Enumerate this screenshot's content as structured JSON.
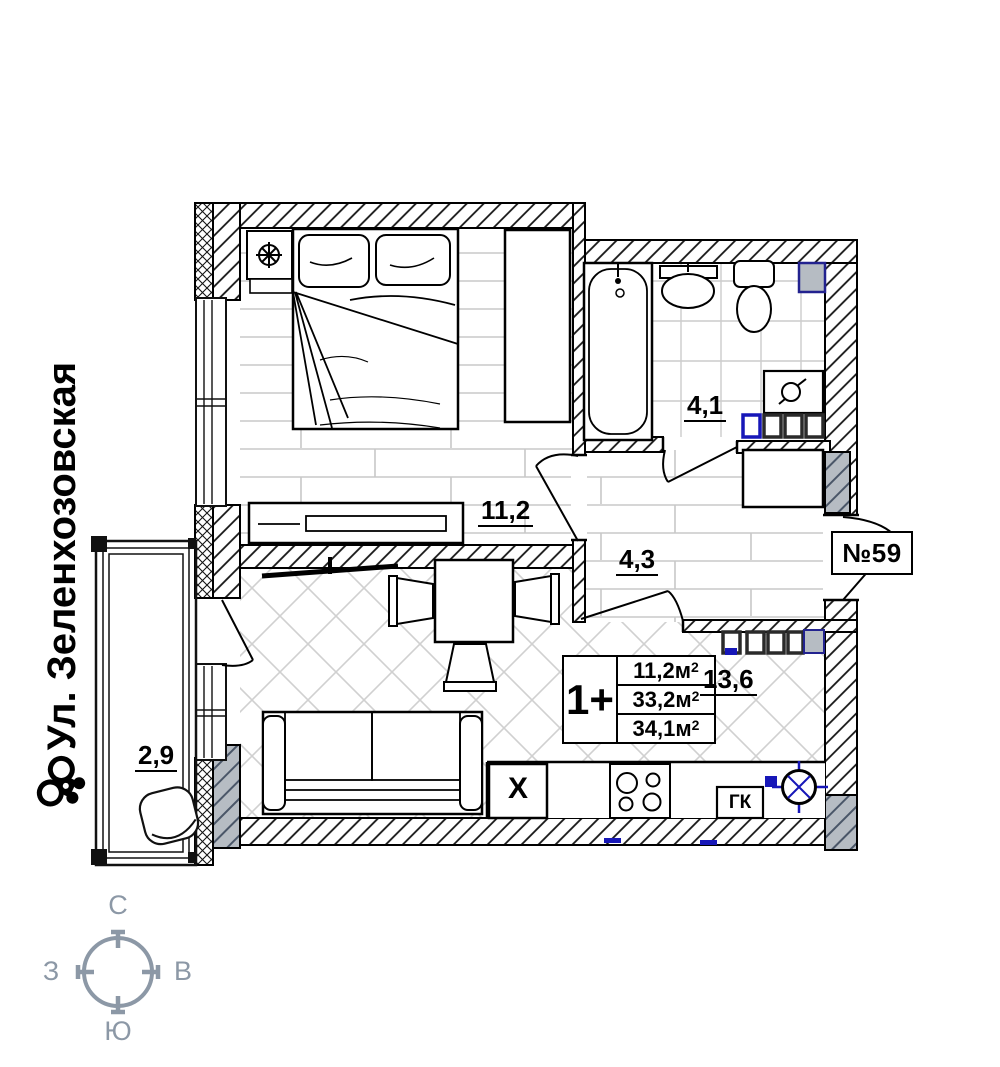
{
  "street": {
    "name": "Ул. Зеленхозовская"
  },
  "plan": {
    "apartment_number": "№59",
    "rooms": {
      "bedroom_area": "11,2",
      "bathroom_area": "4,1",
      "hallway_area": "4,3",
      "kitchen_living_area": "13,6",
      "balcony_area": "2,9"
    },
    "stats": {
      "type": "1+",
      "rows": [
        {
          "value": "11,2м",
          "sup": "2"
        },
        {
          "value": "33,2м",
          "sup": "2"
        },
        {
          "value": "34,1м",
          "sup": "2"
        }
      ]
    },
    "appliances": {
      "fridge": "Х",
      "gas_boiler": "ГК"
    }
  },
  "compass": {
    "north": "С",
    "south": "Ю",
    "west": "З",
    "east": "В"
  },
  "colors": {
    "line": "#151515",
    "blue_accent": "#1717b8",
    "gray_fill": "#b6bcc3",
    "compass": "#8c98a6",
    "floor_line": "#c8c8c8"
  }
}
